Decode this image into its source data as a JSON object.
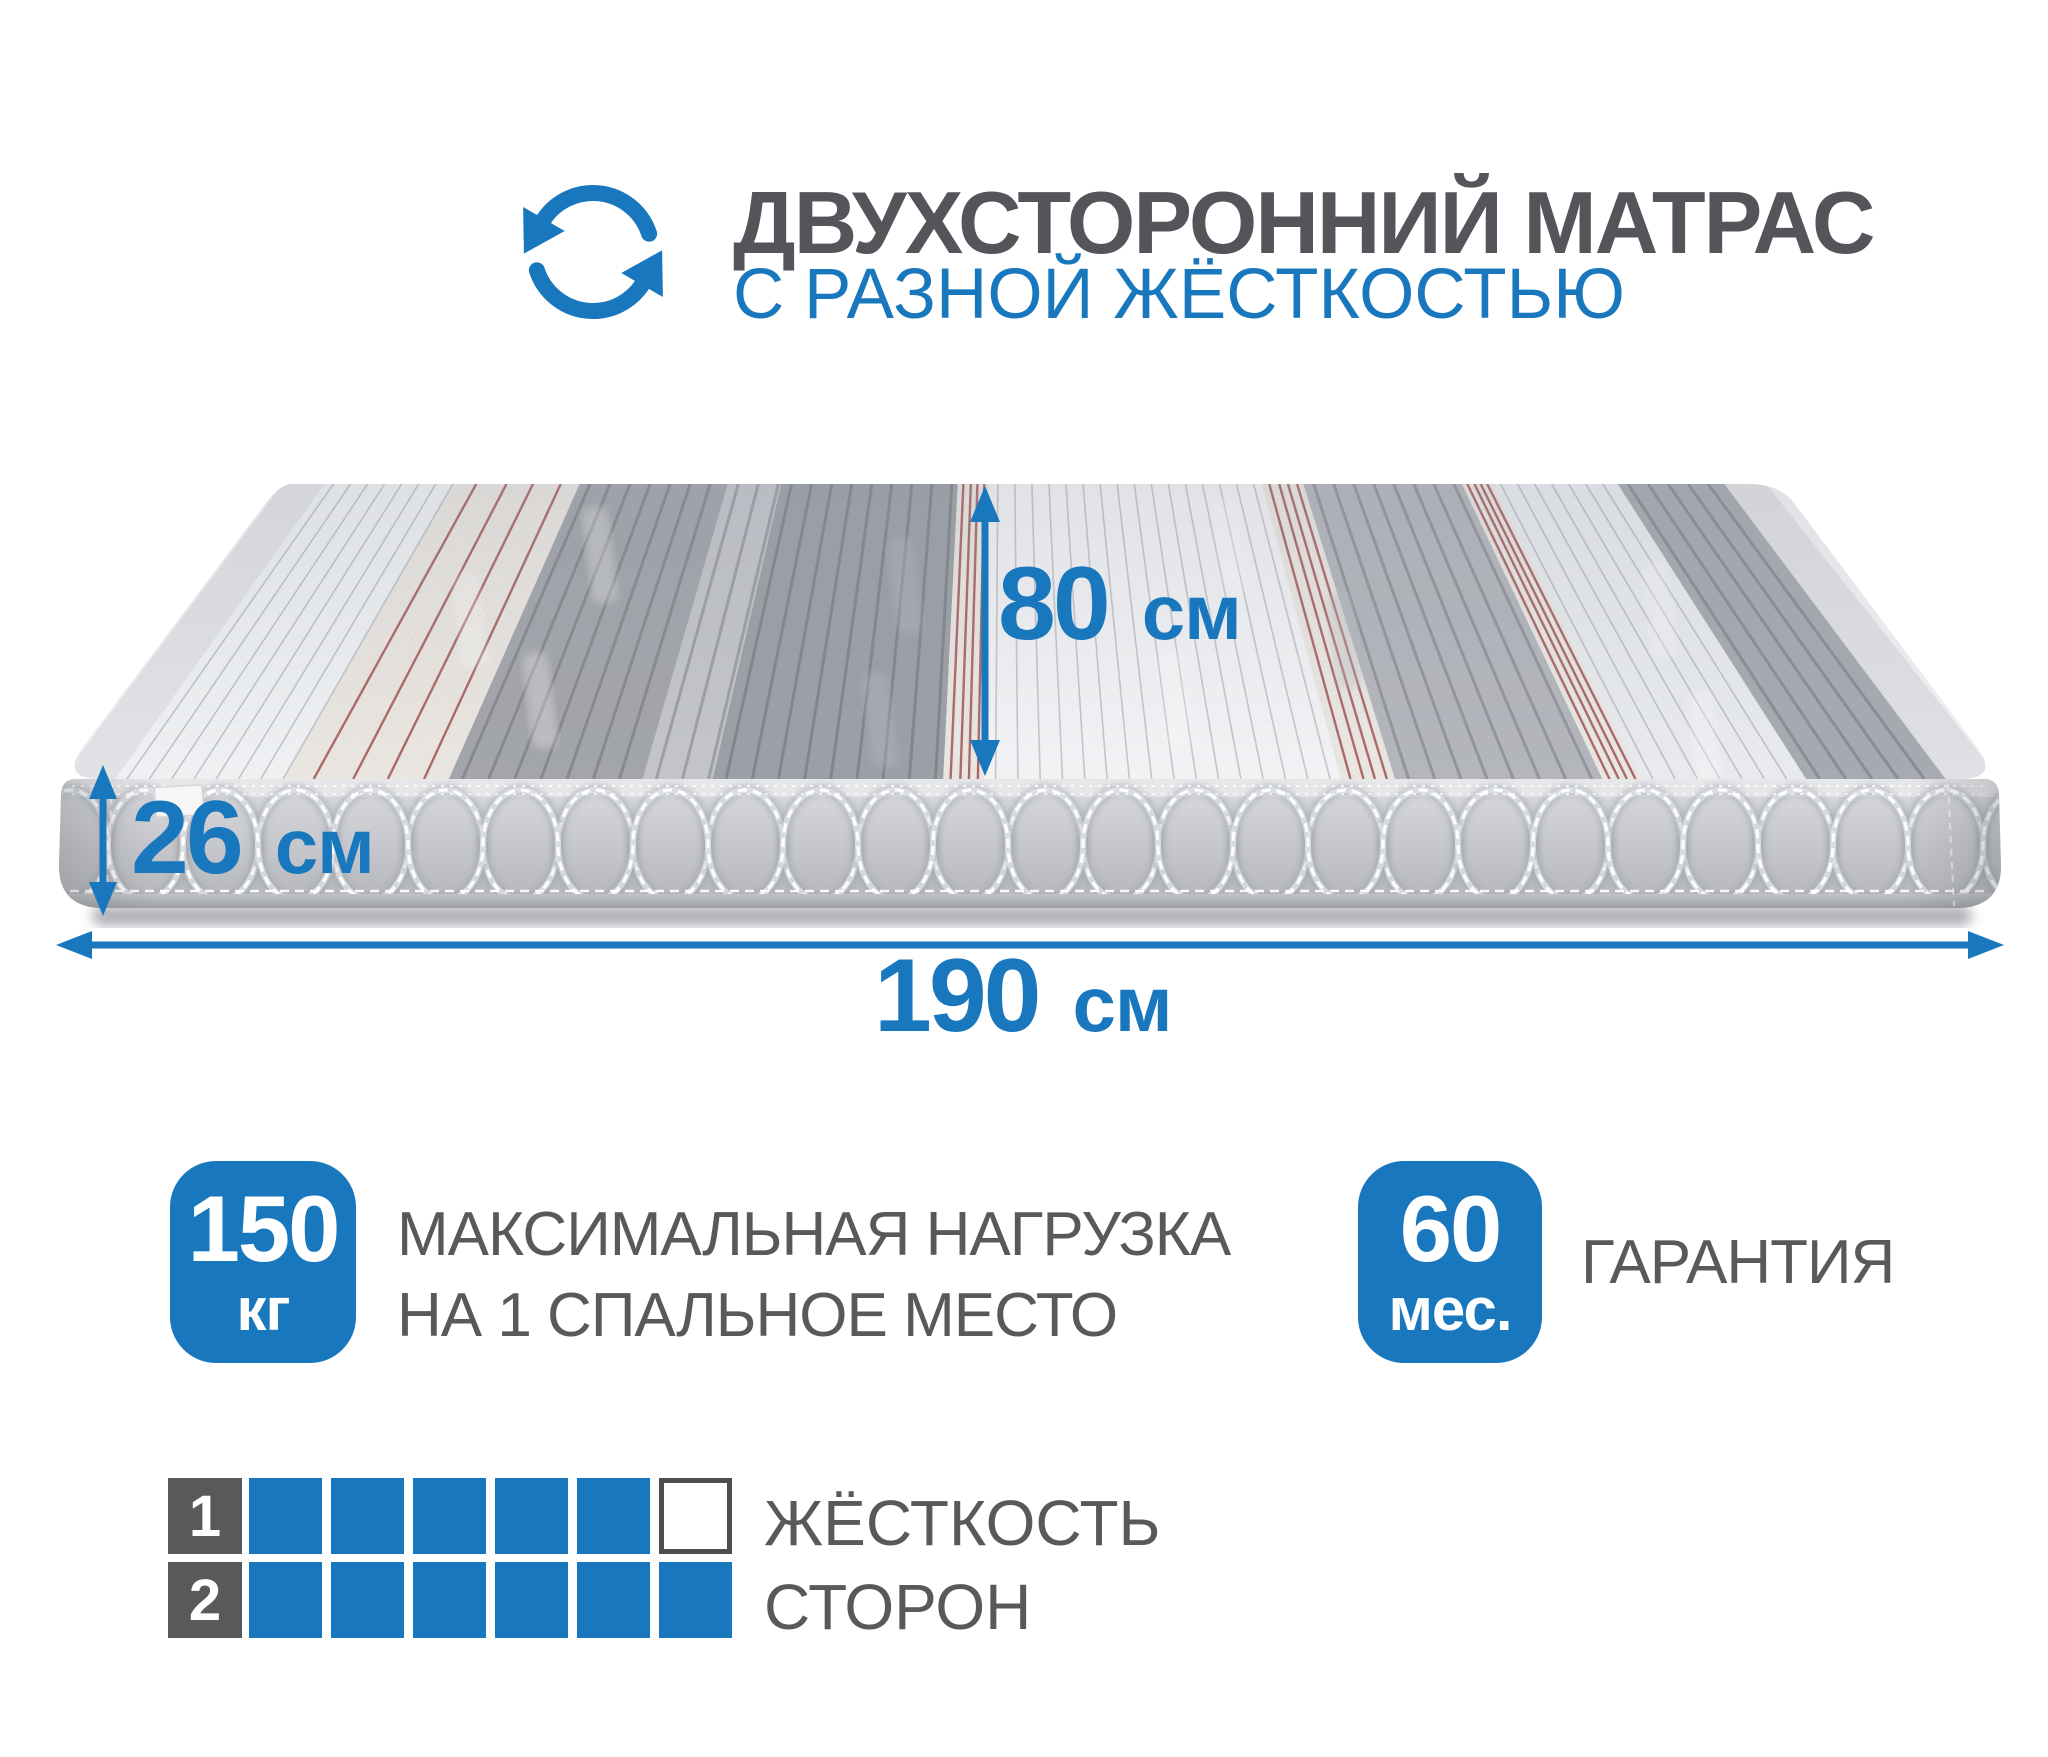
{
  "colors": {
    "accent": "#1877bd",
    "text_gray": "#58595b",
    "stripe_red": "#a45d5c"
  },
  "icons": {
    "rotate": "rotate-arrows-icon"
  },
  "header": {
    "title_line1": "ДВУХСТОРОННИЙ МАТРАС",
    "title_line2": "С РАЗНОЙ ЖЁСТКОСТЬЮ"
  },
  "dimensions": {
    "depth": {
      "value": "80",
      "unit": "см"
    },
    "height": {
      "value": "26",
      "unit": "см"
    },
    "width": {
      "value": "190",
      "unit": "см"
    }
  },
  "features": {
    "max_load": {
      "value": "150",
      "unit": "кг",
      "caption_line1": "МАКСИМАЛЬНАЯ НАГРУЗКА",
      "caption_line2": "НА 1 СПАЛЬНОЕ МЕСТО"
    },
    "warranty": {
      "value": "60",
      "unit": "мес.",
      "caption": "ГАРАНТИЯ"
    }
  },
  "firmness": {
    "caption_line1": "ЖЁСТКОСТЬ",
    "caption_line2": "СТОРОН",
    "scale_max": 6,
    "rows": [
      {
        "label": "1",
        "filled": 5
      },
      {
        "label": "2",
        "filled": 6
      }
    ]
  }
}
